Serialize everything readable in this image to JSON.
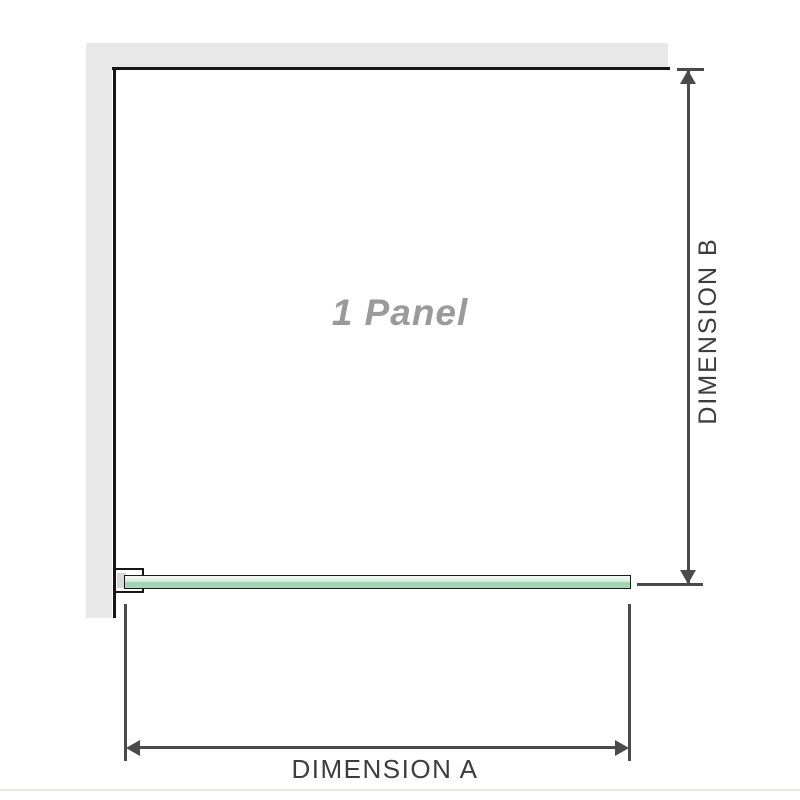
{
  "diagram": {
    "panel_label": "1 Panel",
    "dimension_a": {
      "label": "DIMENSION A"
    },
    "dimension_b": {
      "label": "DIMENSION B"
    }
  },
  "icons": {
    "arrow_up": "triangle-up",
    "arrow_down": "triangle-down",
    "arrow_left": "triangle-left",
    "arrow_right": "triangle-right"
  },
  "colors": {
    "wall_fill": "#e8e8e8",
    "wall_edge": "#161616",
    "glass_fill_light": "#d9eee0",
    "glass_fill_dark": "#9dd2b1",
    "glass_border": "#1a1a1a",
    "dimension_line": "#4a4a4a",
    "label_text": "#3d3d3d",
    "panel_text": "#9a9a9a",
    "divider": "#e9e6e0"
  }
}
